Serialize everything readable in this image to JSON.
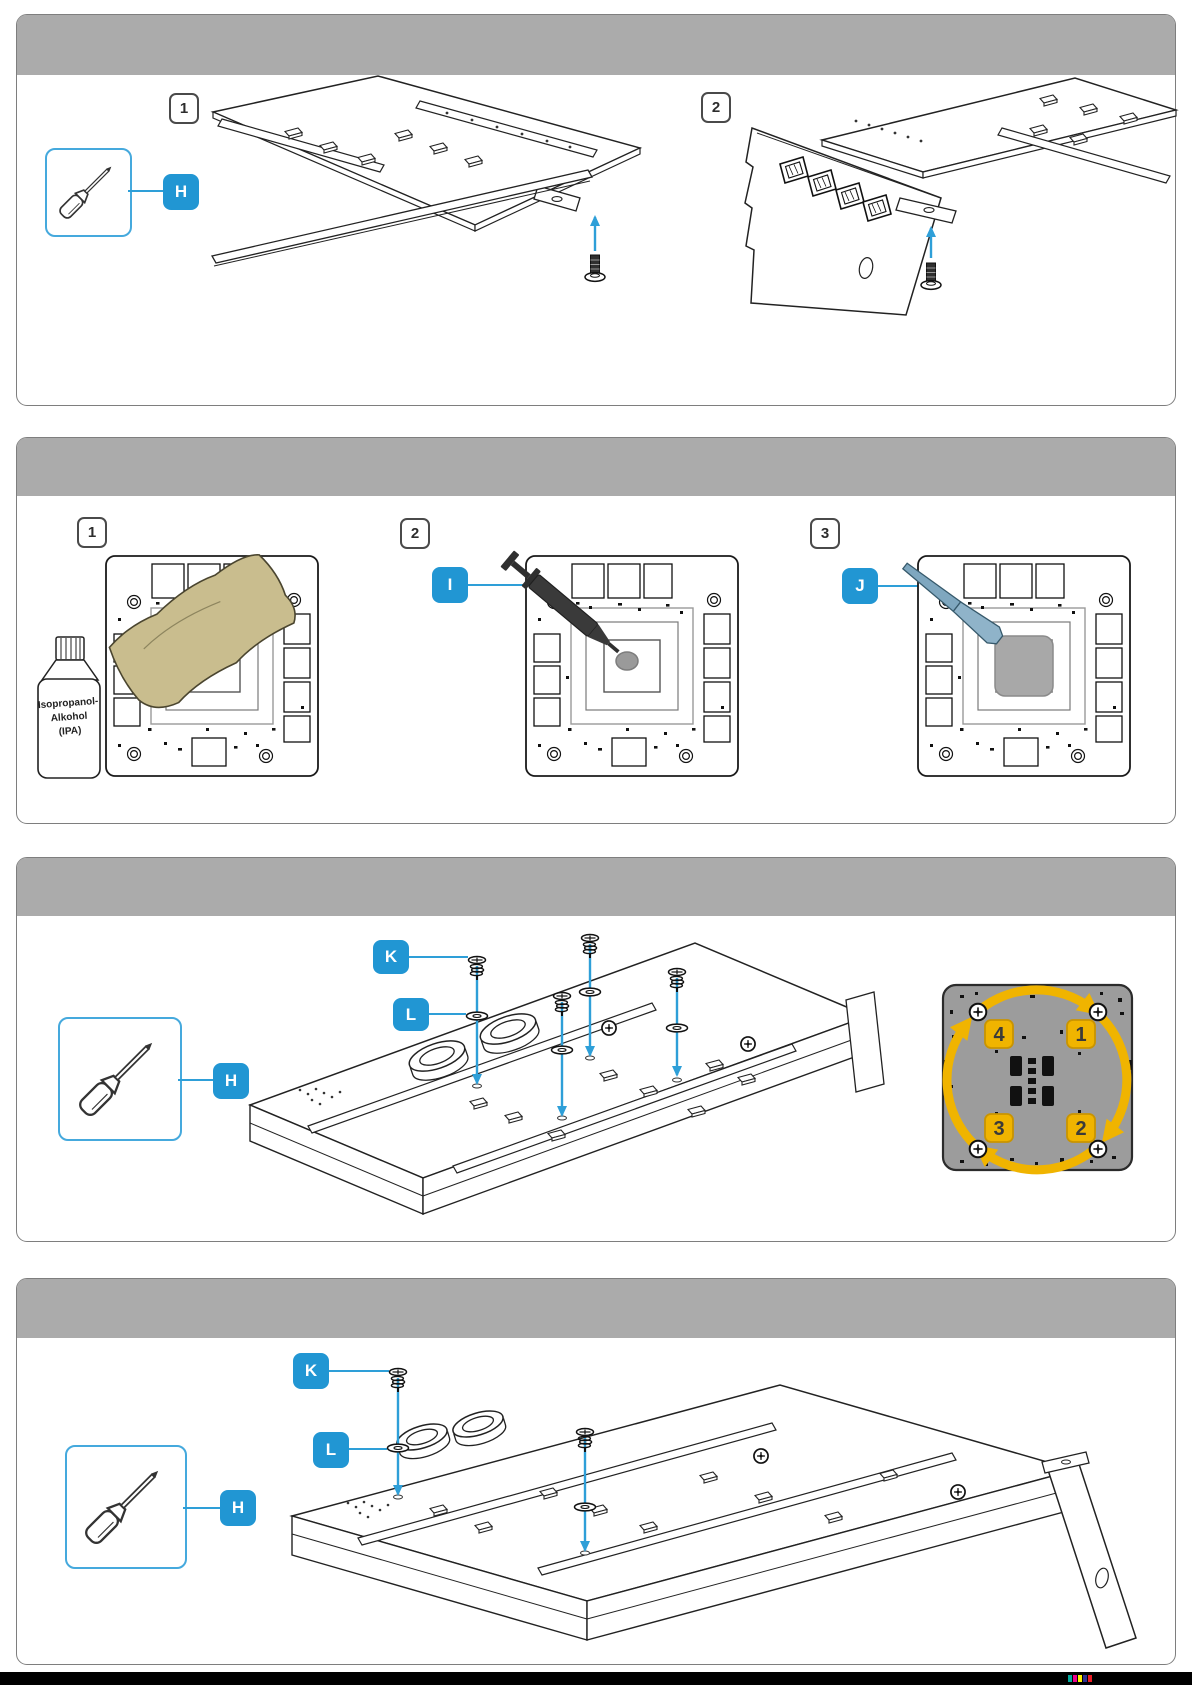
{
  "colors": {
    "accent_blue": "#2196d3",
    "toolbox_border_blue": "#45a9dd",
    "arrow_blue": "#2e9fd8",
    "panel_header_gray": "#ababab",
    "label_yellow": "#f0b400",
    "pcb_back_gray": "#9c9c9c",
    "paste_gray": "#a8a8a8",
    "cloth_tan": "#c9bd8e",
    "spatula_blue": "#7fa7bf",
    "footer_black": "#000000"
  },
  "sections": [
    {
      "steps": [
        {
          "label": "1"
        },
        {
          "label": "2"
        }
      ],
      "tools": [
        {
          "label": "H",
          "icon": "screwdriver-icon"
        }
      ]
    },
    {
      "steps": [
        {
          "label": "1"
        },
        {
          "label": "2"
        },
        {
          "label": "3"
        }
      ],
      "tools": [
        {
          "label": "I",
          "icon": "thermal-paste-syringe-icon"
        },
        {
          "label": "J",
          "icon": "paste-spreader-icon"
        }
      ],
      "bottle_label": {
        "line1": "Isopropanol-",
        "line2": "Alkohol",
        "line3": "(IPA)"
      }
    },
    {
      "tools": [
        {
          "label": "H",
          "icon": "screwdriver-icon"
        },
        {
          "label": "K",
          "icon": "spring-screw-icon"
        },
        {
          "label": "L",
          "icon": "washer-icon"
        }
      ],
      "screw_order": {
        "top_left": "4",
        "top_right": "1",
        "bottom_right": "2",
        "bottom_left": "3"
      }
    },
    {
      "tools": [
        {
          "label": "H",
          "icon": "screwdriver-icon"
        },
        {
          "label": "K",
          "icon": "spring-screw-icon"
        },
        {
          "label": "L",
          "icon": "washer-icon"
        }
      ]
    }
  ]
}
